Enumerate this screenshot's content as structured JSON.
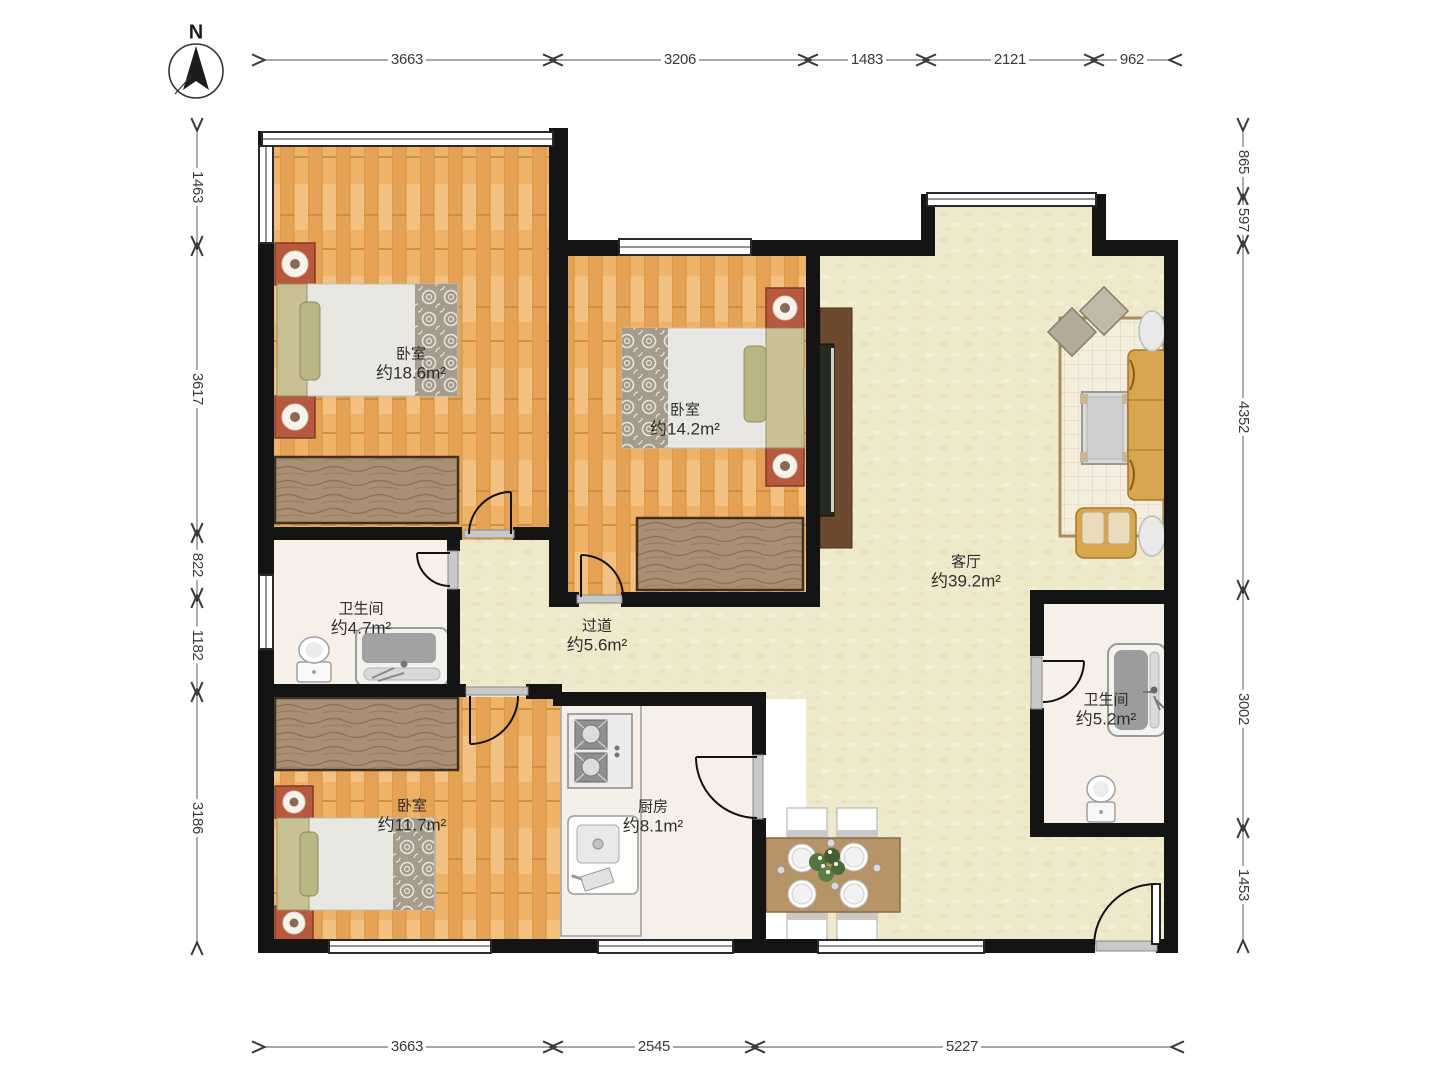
{
  "compass": {
    "label": "N"
  },
  "rooms": [
    {
      "id": "bedroom-master",
      "name": "卧室",
      "area": "约18.6m²"
    },
    {
      "id": "bedroom-middle",
      "name": "卧室",
      "area": "约14.2m²"
    },
    {
      "id": "living-room",
      "name": "客厅",
      "area": "约39.2m²"
    },
    {
      "id": "bathroom-left",
      "name": "卫生间",
      "area": "约4.7m²"
    },
    {
      "id": "hallway",
      "name": "过道",
      "area": "约5.6m²"
    },
    {
      "id": "bedroom-small",
      "name": "卧室",
      "area": "约11.7m²"
    },
    {
      "id": "kitchen",
      "name": "厨房",
      "area": "约8.1m²"
    },
    {
      "id": "bathroom-right",
      "name": "卫生间",
      "area": "约5.2m²"
    }
  ],
  "dimensions": {
    "top": [
      "3663",
      "3206",
      "1483",
      "2121",
      "962"
    ],
    "bottom": [
      "3663",
      "2545",
      "5227"
    ],
    "left": [
      "1463",
      "3617",
      "822",
      "1182",
      "3186"
    ],
    "right": [
      "865",
      "597",
      "4352",
      "3002",
      "1453"
    ]
  },
  "colors": {
    "wall": "#141414",
    "wood_floor": "#eeb269",
    "living_floor": "#efe9cb",
    "tile_floor": "#f7f0e8",
    "sofa_accent": "#d8a64f",
    "nightstand": "#b8593e",
    "furniture_wood": "#a98f74",
    "dimension_line": "#8a8a8a"
  }
}
